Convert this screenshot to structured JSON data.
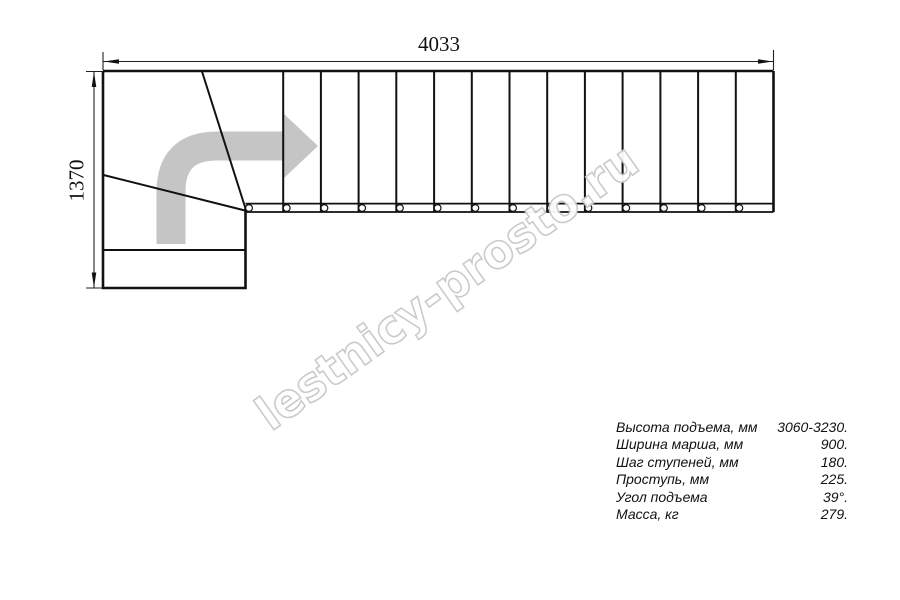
{
  "drawing": {
    "title": "stair-plan",
    "width_dim": "4033",
    "height_dim": "1370",
    "straight_treads": 14,
    "winder_treads": 3,
    "baluster_count": 14
  },
  "specs": [
    {
      "label": "Высота подъема, мм",
      "value": "3060-3230."
    },
    {
      "label": "Ширина марша, мм",
      "value": "900."
    },
    {
      "label": "Шаг ступеней, мм",
      "value": "180."
    },
    {
      "label": "Проступь, мм",
      "value": "225."
    },
    {
      "label": "Угол подъема",
      "value": "39°."
    },
    {
      "label": "Масса, кг",
      "value": "279."
    }
  ],
  "watermark": "lestnicy-prosto.ru",
  "colors": {
    "line": "#111111",
    "direction_arrow": "#c5c5c5",
    "watermark_outline": "#c8c8c8",
    "watermark_fill": "#ffffff",
    "background": "#ffffff"
  }
}
